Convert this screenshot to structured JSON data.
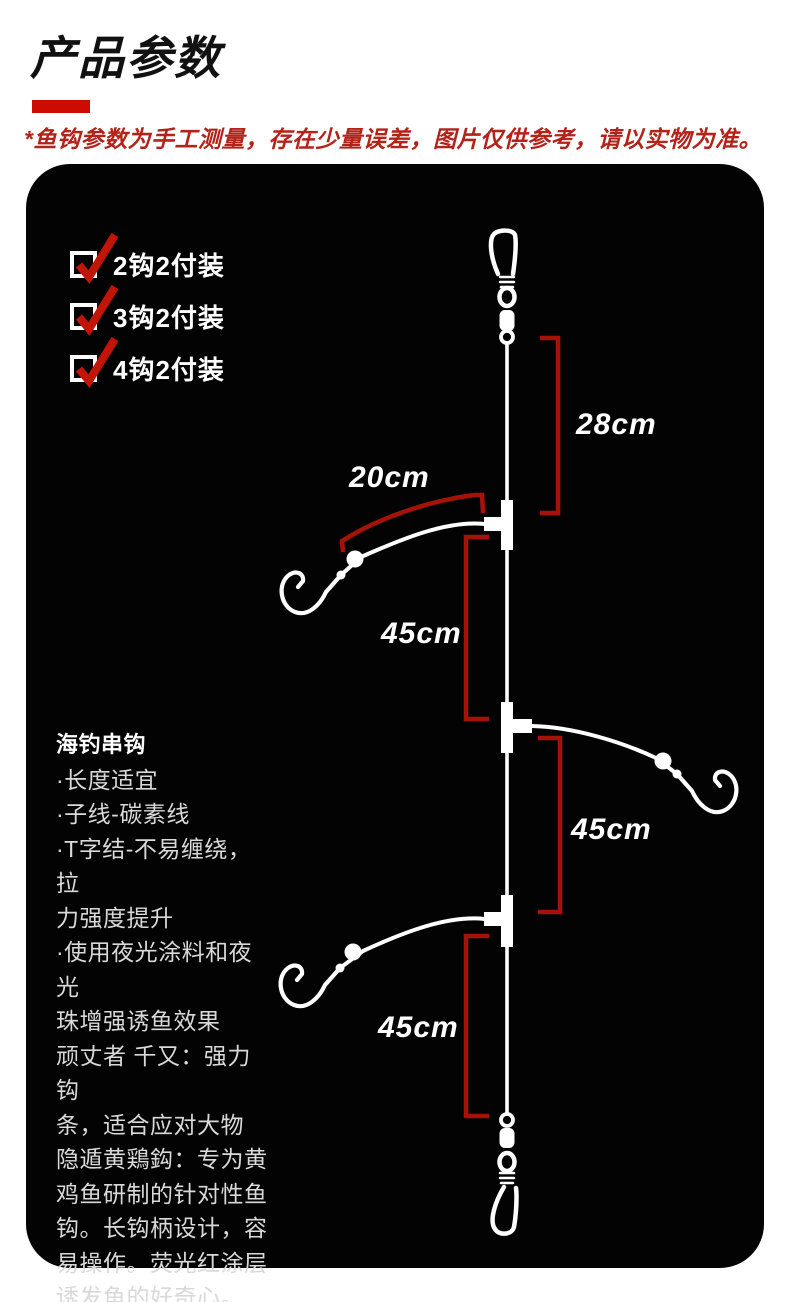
{
  "header": {
    "title": "产品参数",
    "disclaimer": "*鱼钩参数为手工测量，存在少量误差，图片仅供参考，请以实物为准。"
  },
  "options": [
    {
      "label": "2钩2付装",
      "checked": true
    },
    {
      "label": "3钩2付装",
      "checked": true
    },
    {
      "label": "4钩2付装",
      "checked": true
    }
  ],
  "description": {
    "title": "海钓串钩",
    "lines": [
      "·长度适宜",
      "·子线-碳素线",
      "·T字结-不易缠绕，拉",
      "力强度提升",
      "·使用夜光涂料和夜光",
      "珠增强诱鱼效果",
      "顽丈者 千又：强力钩",
      "条，适合应对大物",
      "隐遁黄鶏鈎：专为黄",
      "鸡鱼研制的针对性鱼",
      "钩。长钩柄设计，容",
      "易操作。荧光红涂层",
      "诱发鱼的好奇心。"
    ]
  },
  "measurements": {
    "top_segment": "28cm",
    "branch_length": "20cm",
    "segment1": "45cm",
    "segment2": "45cm",
    "segment3": "45cm"
  },
  "colors": {
    "accent_red": "#c21508",
    "bracket_red": "#a61208",
    "underline_red": "#cc0b01",
    "disclaimer_red": "#b3231a",
    "panel_black": "#030303",
    "line_white": "#ffffff"
  }
}
